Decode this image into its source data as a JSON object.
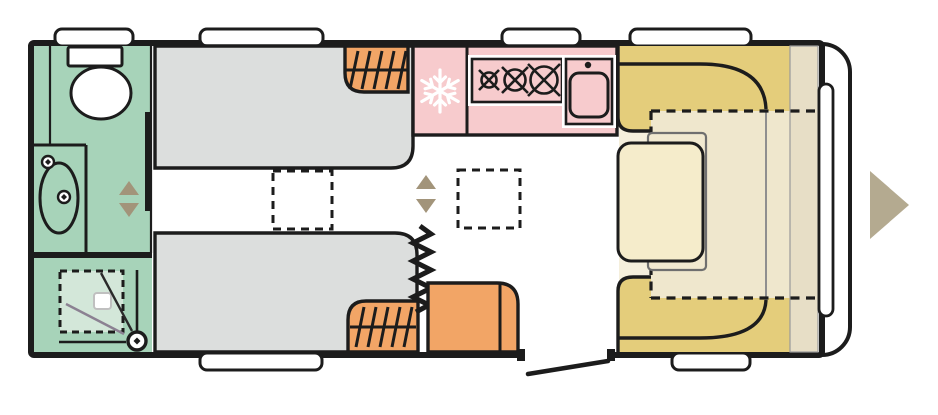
{
  "diagram": {
    "kind": "caravan-floorplan-top-view",
    "areas": [
      {
        "name": "washroom-toilet-basin",
        "color_ref": "bathroom_floor"
      },
      {
        "name": "shower-cubicle",
        "color_ref": "shower_tray"
      },
      {
        "name": "twin-single-beds",
        "color_ref": "bed"
      },
      {
        "name": "wardrobes-and-cabinet",
        "color_ref": "furniture_orange"
      },
      {
        "name": "kitchen-fridge-hob-sink",
        "color_ref": "kitchen_pink"
      },
      {
        "name": "u-shaped-lounge",
        "color_ref": "sofa_yellow"
      },
      {
        "name": "lounge-table",
        "color_ref": "table_cream"
      },
      {
        "name": "bed-conversion-area",
        "color_ref": "bed_conversion_floor"
      }
    ]
  },
  "icons": {
    "snowflake-icon": "fridge-freezer",
    "hob-burner-icon": "gas-burner-x3",
    "sink-icon": "kitchen-sink",
    "slide-arrows-icon": "up-down-triangles",
    "direction-arrow-icon": "right-triangle",
    "hanger-rail-icon": "wardrobe-hatching",
    "zigzag-icon": "concertina-partition",
    "door-leaf-icon": "entrance-door-swing"
  },
  "colors": {
    "wall": "#1c1c1c",
    "background": "#ffffff",
    "bathroom_floor": "#a7d3b9",
    "shower_tray": "#d3e7d9",
    "fixture_white": "#ffffff",
    "bed": "#dcdedd",
    "furniture_orange": "#f2a566",
    "kitchen_pink": "#f7cbcd",
    "sofa_yellow": "#e4cd7b",
    "lounge_floor": "#f5efdc",
    "bed_conversion_floor": "#efe7cd",
    "sideboard_beige": "#e7dec6",
    "table_cream": "#f5eccb",
    "table_ext_cream": "#f1e9d0",
    "gray_line": "#8f8f8f",
    "screen_gray": "#8b8192",
    "arrow_tan": "#b4aa90",
    "triangle_brown": "#a2947a"
  }
}
